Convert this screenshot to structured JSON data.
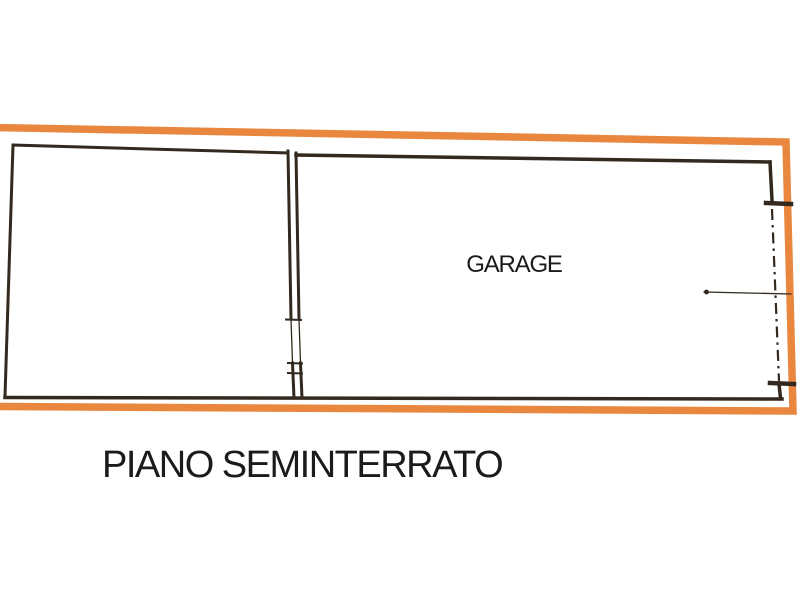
{
  "caption": {
    "text": "PIANO SEMINTERRATO"
  },
  "plan": {
    "garage_label": "GARAGE",
    "rooms": [
      {
        "id": "side-room",
        "label": ""
      },
      {
        "id": "garage",
        "label": "GARAGE"
      }
    ]
  },
  "colors": {
    "background": "#ffffff",
    "boundary_orange": "#ea873e",
    "wall_black": "#33291f",
    "text_black": "#1b1b1b"
  }
}
